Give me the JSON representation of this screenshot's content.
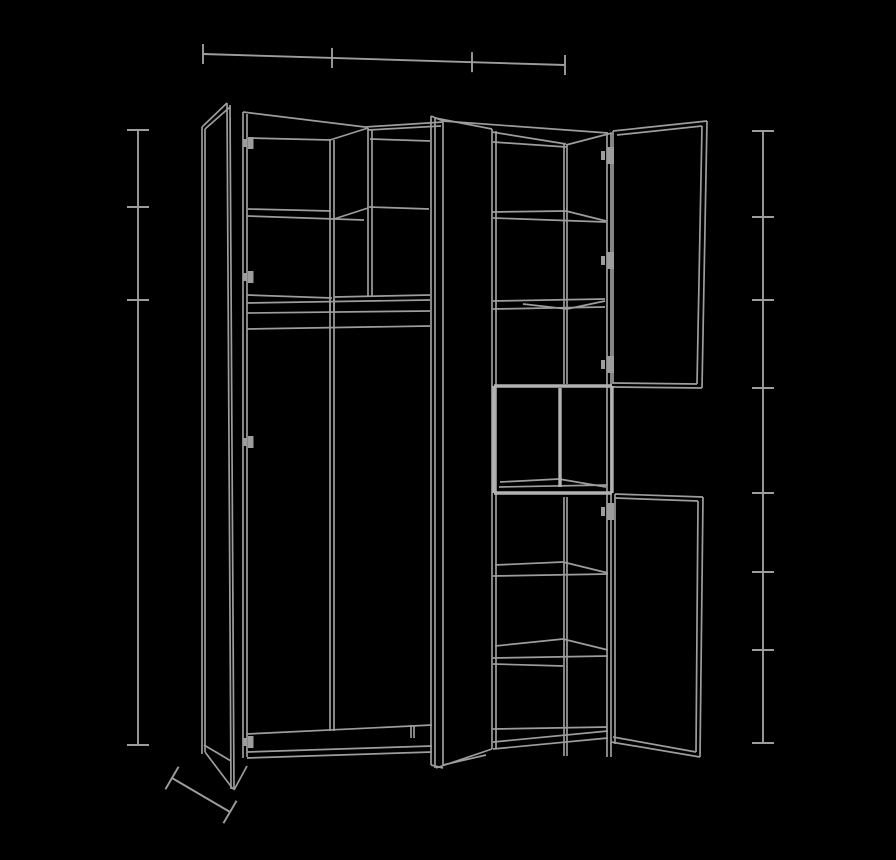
{
  "meta": {
    "title": "wardrobe-open-doors-technical-drawing",
    "background_color": "#000000",
    "canvas": {
      "width": 896,
      "height": 860
    }
  },
  "style": {
    "line_color": "#9d9d9d",
    "line_width": 1.7,
    "dimension_line_width": 1.9,
    "highlight_color": "#b2b2b2",
    "highlight_width": 3.4
  },
  "drawing": {
    "wardrobe_segments": [
      [
        202,
        127,
        202,
        754
      ],
      [
        205,
        129,
        205,
        752
      ],
      [
        227,
        103,
        231,
        789
      ],
      [
        230,
        105,
        234,
        790
      ],
      [
        202,
        127,
        227,
        103
      ],
      [
        205,
        129,
        230,
        107
      ],
      [
        205,
        752,
        233,
        789
      ],
      [
        234,
        790,
        247,
        766
      ],
      [
        204,
        745,
        231,
        761
      ],
      [
        243,
        112,
        243,
        758
      ],
      [
        247,
        114,
        247,
        757
      ],
      [
        243,
        112,
        365,
        127
      ],
      [
        248,
        138,
        330,
        140
      ],
      [
        330,
        140,
        368,
        128
      ],
      [
        365,
        127,
        443,
        122
      ],
      [
        368,
        130,
        441,
        126
      ],
      [
        370,
        139,
        430,
        141
      ],
      [
        330,
        139,
        330,
        731
      ],
      [
        334,
        140,
        334,
        731
      ],
      [
        368,
        128,
        368,
        296
      ],
      [
        372,
        129,
        372,
        296
      ],
      [
        248,
        209,
        331,
        211
      ],
      [
        247,
        216,
        364,
        220
      ],
      [
        334,
        219,
        368,
        208
      ],
      [
        369,
        207,
        429,
        209
      ],
      [
        247,
        295,
        332,
        298
      ],
      [
        334,
        297,
        430,
        295
      ],
      [
        247,
        303,
        430,
        300
      ],
      [
        247,
        313,
        430,
        311
      ],
      [
        247,
        329,
        430,
        326
      ],
      [
        330,
        299,
        330,
        312
      ],
      [
        334,
        299,
        334,
        312
      ],
      [
        247,
        734,
        432,
        725
      ],
      [
        247,
        752,
        432,
        746
      ],
      [
        247,
        758,
        432,
        752
      ],
      [
        411,
        725,
        411,
        738
      ],
      [
        414,
        726,
        414,
        738
      ],
      [
        431,
        116,
        431,
        765
      ],
      [
        435,
        118,
        435,
        768
      ],
      [
        443,
        122,
        443,
        766
      ],
      [
        431,
        116,
        443,
        121
      ],
      [
        443,
        121,
        608,
        133
      ],
      [
        435,
        118,
        492,
        129
      ],
      [
        431,
        765,
        443,
        768
      ],
      [
        436,
        768,
        492,
        749
      ],
      [
        443,
        765,
        486,
        755
      ],
      [
        492,
        129,
        492,
        749
      ],
      [
        496,
        131,
        496,
        748
      ],
      [
        564,
        144,
        564,
        384
      ],
      [
        567,
        145,
        567,
        384
      ],
      [
        564,
        497,
        564,
        756
      ],
      [
        567,
        497,
        567,
        756
      ],
      [
        607,
        133,
        607,
        757
      ],
      [
        611,
        134,
        611,
        757
      ],
      [
        492,
        132,
        566,
        144
      ],
      [
        493,
        142,
        566,
        147
      ],
      [
        566,
        145,
        612,
        133
      ],
      [
        493,
        729,
        607,
        727
      ],
      [
        493,
        742,
        608,
        731
      ],
      [
        493,
        749,
        608,
        738
      ],
      [
        492,
        212,
        566,
        211
      ],
      [
        566,
        211,
        606,
        221
      ],
      [
        493,
        218,
        606,
        222
      ],
      [
        493,
        301,
        605,
        299
      ],
      [
        493,
        309,
        605,
        307
      ],
      [
        523,
        304,
        567,
        309
      ],
      [
        567,
        309,
        605,
        301
      ],
      [
        495,
        565,
        563,
        562
      ],
      [
        563,
        562,
        608,
        573
      ],
      [
        493,
        576,
        608,
        574
      ],
      [
        495,
        646,
        563,
        639
      ],
      [
        563,
        639,
        608,
        650
      ],
      [
        493,
        658,
        608,
        656
      ],
      [
        493,
        664,
        563,
        666
      ],
      [
        613,
        131,
        613,
        384
      ],
      [
        613,
        131,
        707,
        121
      ],
      [
        617,
        135,
        702,
        126
      ],
      [
        707,
        121,
        702,
        388
      ],
      [
        702,
        126,
        697,
        384
      ],
      [
        613,
        387,
        702,
        388
      ],
      [
        613,
        383,
        697,
        384
      ],
      [
        615,
        494,
        615,
        744
      ],
      [
        615,
        494,
        703,
        497
      ],
      [
        615,
        498,
        698,
        501
      ],
      [
        703,
        497,
        700,
        757
      ],
      [
        698,
        501,
        696,
        752
      ],
      [
        611,
        742,
        700,
        757
      ],
      [
        613,
        737,
        696,
        752
      ],
      [
        500,
        482,
        559,
        479
      ],
      [
        559,
        479,
        606,
        487
      ],
      [
        499,
        487,
        607,
        485
      ]
    ],
    "highlight_segments": [
      [
        494,
        386,
        612,
        386
      ],
      [
        612,
        386,
        612,
        493
      ],
      [
        612,
        493,
        494,
        493
      ],
      [
        494,
        493,
        494,
        386
      ],
      [
        560,
        388,
        560,
        487
      ]
    ],
    "hinges": [
      {
        "side": "left",
        "x": 243,
        "y": 137
      },
      {
        "side": "left",
        "x": 243,
        "y": 271
      },
      {
        "side": "left",
        "x": 243,
        "y": 436
      },
      {
        "side": "left",
        "x": 243,
        "y": 736
      },
      {
        "side": "right",
        "x": 601,
        "y": 147
      },
      {
        "side": "right",
        "x": 601,
        "y": 252
      },
      {
        "side": "right",
        "x": 601,
        "y": 356
      },
      {
        "side": "right",
        "x": 601,
        "y": 503
      }
    ],
    "dimensions": {
      "top_width": {
        "x1": 203,
        "y1": 54,
        "x2": 565,
        "y2": 65,
        "tick_xs": [
          203,
          332,
          472,
          565
        ],
        "tick_half": 10
      },
      "left_height": {
        "x": 138,
        "y1": 130,
        "y2": 745,
        "tick_ys": [
          130,
          207,
          300,
          745
        ],
        "tick_half": 11
      },
      "right_height": {
        "x": 763,
        "y1": 131,
        "y2": 743,
        "tick_ys": [
          131,
          217,
          300,
          388,
          493,
          572,
          650,
          743
        ],
        "tick_half": 11
      },
      "depth": {
        "x1": 172,
        "y1": 778,
        "x2": 230,
        "y2": 812,
        "end_tick_half": 13
      }
    }
  }
}
